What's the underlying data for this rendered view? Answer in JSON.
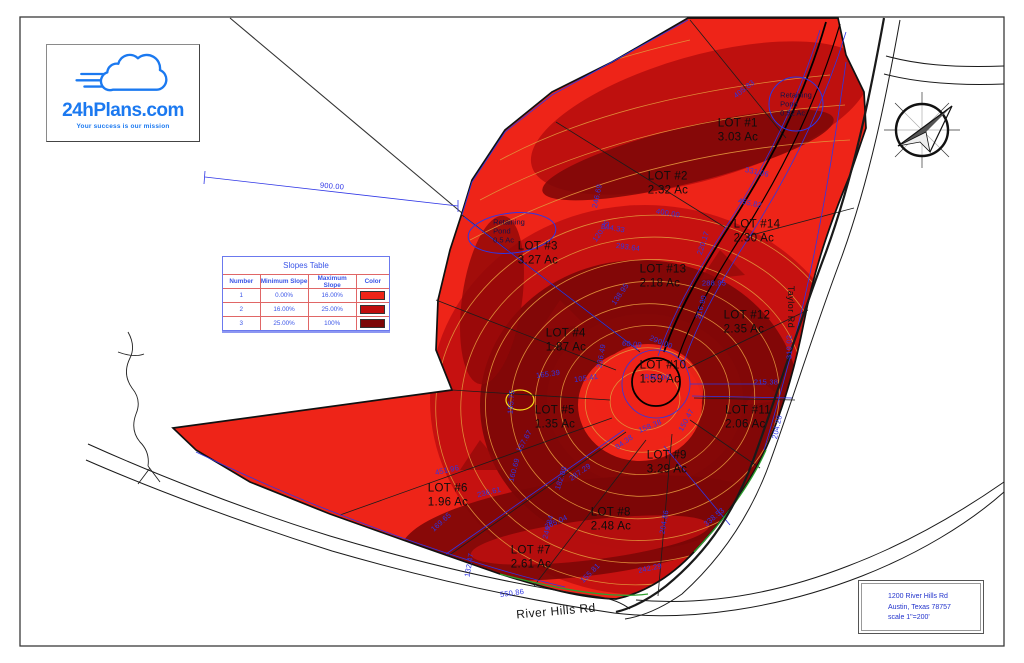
{
  "logo": {
    "name": "24hPlans.com",
    "tagline": "Your success is our mission",
    "brand_color": "#1b79f0"
  },
  "slopes_table": {
    "title": "Slopes Table",
    "headers": [
      "Number",
      "Minimum Slope",
      "Maximum Slope",
      "Color"
    ],
    "rows": [
      {
        "number": "1",
        "min": "0.00%",
        "max": "16.00%",
        "color": "#ee2418"
      },
      {
        "number": "2",
        "min": "16.00%",
        "max": "25.00%",
        "color": "#c00d0d"
      },
      {
        "number": "3",
        "min": "25.00%",
        "max": "100%",
        "color": "#7c0707"
      }
    ]
  },
  "map": {
    "lots": [
      {
        "label": "LOT #1",
        "area": "3.03 Ac",
        "x": 738,
        "y": 131
      },
      {
        "label": "LOT #2",
        "area": "2.32 Ac",
        "x": 668,
        "y": 184
      },
      {
        "label": "LOT #3",
        "area": "3.27 Ac",
        "x": 538,
        "y": 254
      },
      {
        "label": "LOT #4",
        "area": "1.87 Ac",
        "x": 566,
        "y": 341
      },
      {
        "label": "LOT #5",
        "area": "1.35 Ac",
        "x": 555,
        "y": 418
      },
      {
        "label": "LOT #6",
        "area": "1.96 Ac",
        "x": 448,
        "y": 496
      },
      {
        "label": "LOT #7",
        "area": "2.61 Ac",
        "x": 531,
        "y": 558
      },
      {
        "label": "LOT #8",
        "area": "2.48 Ac",
        "x": 611,
        "y": 520
      },
      {
        "label": "LOT #9",
        "area": "3.29 Ac",
        "x": 667,
        "y": 463
      },
      {
        "label": "LOT #10",
        "area": "1.59 Ac",
        "x": 663,
        "y": 373
      },
      {
        "label": "LOT #11",
        "area": "2.06 Ac",
        "x": 748,
        "y": 418
      },
      {
        "label": "LOT #12",
        "area": "2.35 Ac",
        "x": 747,
        "y": 323
      },
      {
        "label": "LOT #13",
        "area": "2.18 Ac",
        "x": 663,
        "y": 277
      },
      {
        "label": "LOT #14",
        "area": "2.30 Ac",
        "x": 757,
        "y": 232
      }
    ],
    "ponds": [
      {
        "lines": [
          "Retaining",
          "Pond",
          "0.52 Ac"
        ],
        "x": 796,
        "y": 104
      },
      {
        "lines": [
          "Retaining",
          "Pond",
          "0.5 Ac"
        ],
        "x": 509,
        "y": 231
      }
    ],
    "dimensions": [
      {
        "text": "900.00",
        "x": 332,
        "y": 186,
        "rot": 5
      },
      {
        "text": "405.83",
        "x": 744,
        "y": 89,
        "rot": -38
      },
      {
        "text": "331.06",
        "x": 757,
        "y": 172,
        "rot": 12
      },
      {
        "text": "455.82",
        "x": 750,
        "y": 203,
        "rot": 12
      },
      {
        "text": "400.00",
        "x": 668,
        "y": 213,
        "rot": 10
      },
      {
        "text": "244.33",
        "x": 613,
        "y": 228,
        "rot": 10
      },
      {
        "text": "293.64",
        "x": 628,
        "y": 247,
        "rot": 8
      },
      {
        "text": "246.69",
        "x": 597,
        "y": 196,
        "rot": -78
      },
      {
        "text": "220.17",
        "x": 703,
        "y": 243,
        "rot": -72
      },
      {
        "text": "120.25",
        "x": 601,
        "y": 231,
        "rot": -55
      },
      {
        "text": "288.95",
        "x": 714,
        "y": 283,
        "rot": 0
      },
      {
        "text": "216.90",
        "x": 701,
        "y": 307,
        "rot": -75
      },
      {
        "text": "138.95",
        "x": 620,
        "y": 294,
        "rot": -55
      },
      {
        "text": "290.00",
        "x": 661,
        "y": 342,
        "rot": 22
      },
      {
        "text": "60.00",
        "x": 632,
        "y": 344,
        "rot": 5
      },
      {
        "text": "319.02",
        "x": 789,
        "y": 347,
        "rot": -90
      },
      {
        "text": "R60.00",
        "x": 657,
        "y": 377,
        "rot": 0
      },
      {
        "text": "215.38",
        "x": 766,
        "y": 382,
        "rot": 0
      },
      {
        "text": "165.39",
        "x": 548,
        "y": 374,
        "rot": -8
      },
      {
        "text": "105.41",
        "x": 586,
        "y": 378,
        "rot": -8
      },
      {
        "text": "236.49",
        "x": 601,
        "y": 356,
        "rot": -80
      },
      {
        "text": "158.38",
        "x": 650,
        "y": 426,
        "rot": -22
      },
      {
        "text": "94.38",
        "x": 624,
        "y": 442,
        "rot": -35
      },
      {
        "text": "150.47",
        "x": 686,
        "y": 420,
        "rot": -62
      },
      {
        "text": "204.28",
        "x": 777,
        "y": 427,
        "rot": -78
      },
      {
        "text": "155.75",
        "x": 511,
        "y": 402,
        "rot": -85
      },
      {
        "text": "287.29",
        "x": 580,
        "y": 472,
        "rot": -35
      },
      {
        "text": "182.09",
        "x": 561,
        "y": 478,
        "rot": -72
      },
      {
        "text": "157.67",
        "x": 524,
        "y": 441,
        "rot": -60
      },
      {
        "text": "451.96",
        "x": 447,
        "y": 470,
        "rot": -13
      },
      {
        "text": "236.61",
        "x": 489,
        "y": 492,
        "rot": -14
      },
      {
        "text": "169.65",
        "x": 441,
        "y": 522,
        "rot": -42
      },
      {
        "text": "160.69",
        "x": 514,
        "y": 470,
        "rot": -75
      },
      {
        "text": "265.04",
        "x": 556,
        "y": 522,
        "rot": -25
      },
      {
        "text": "249.84",
        "x": 548,
        "y": 527,
        "rot": -75
      },
      {
        "text": "204.86",
        "x": 664,
        "y": 522,
        "rot": -80
      },
      {
        "text": "338.53",
        "x": 714,
        "y": 517,
        "rot": -40
      },
      {
        "text": "242.29",
        "x": 650,
        "y": 568,
        "rot": -12
      },
      {
        "text": "155.81",
        "x": 590,
        "y": 573,
        "rot": -45
      },
      {
        "text": "550.86",
        "x": 512,
        "y": 593,
        "rot": -8
      },
      {
        "text": "132.47",
        "x": 469,
        "y": 565,
        "rot": -80
      }
    ],
    "roads": [
      {
        "name": "River Hills Rd",
        "x": 556,
        "y": 611,
        "rot": -5,
        "vertical": false
      },
      {
        "name": "Taylor Rd",
        "x": 791,
        "y": 307,
        "rot": 90,
        "vertical": true
      }
    ],
    "colors": {
      "slope_low": "#ee2418",
      "slope_mid": "#c21010",
      "slope_high": "#7c0707",
      "contour": "#e2933b",
      "dimension_blue": "#2f36e6",
      "boundary": "#111111"
    }
  },
  "title_block": {
    "lines": [
      "1200 River Hills Rd",
      "Austin, Texas 78757",
      "scale 1\"=200'"
    ]
  }
}
